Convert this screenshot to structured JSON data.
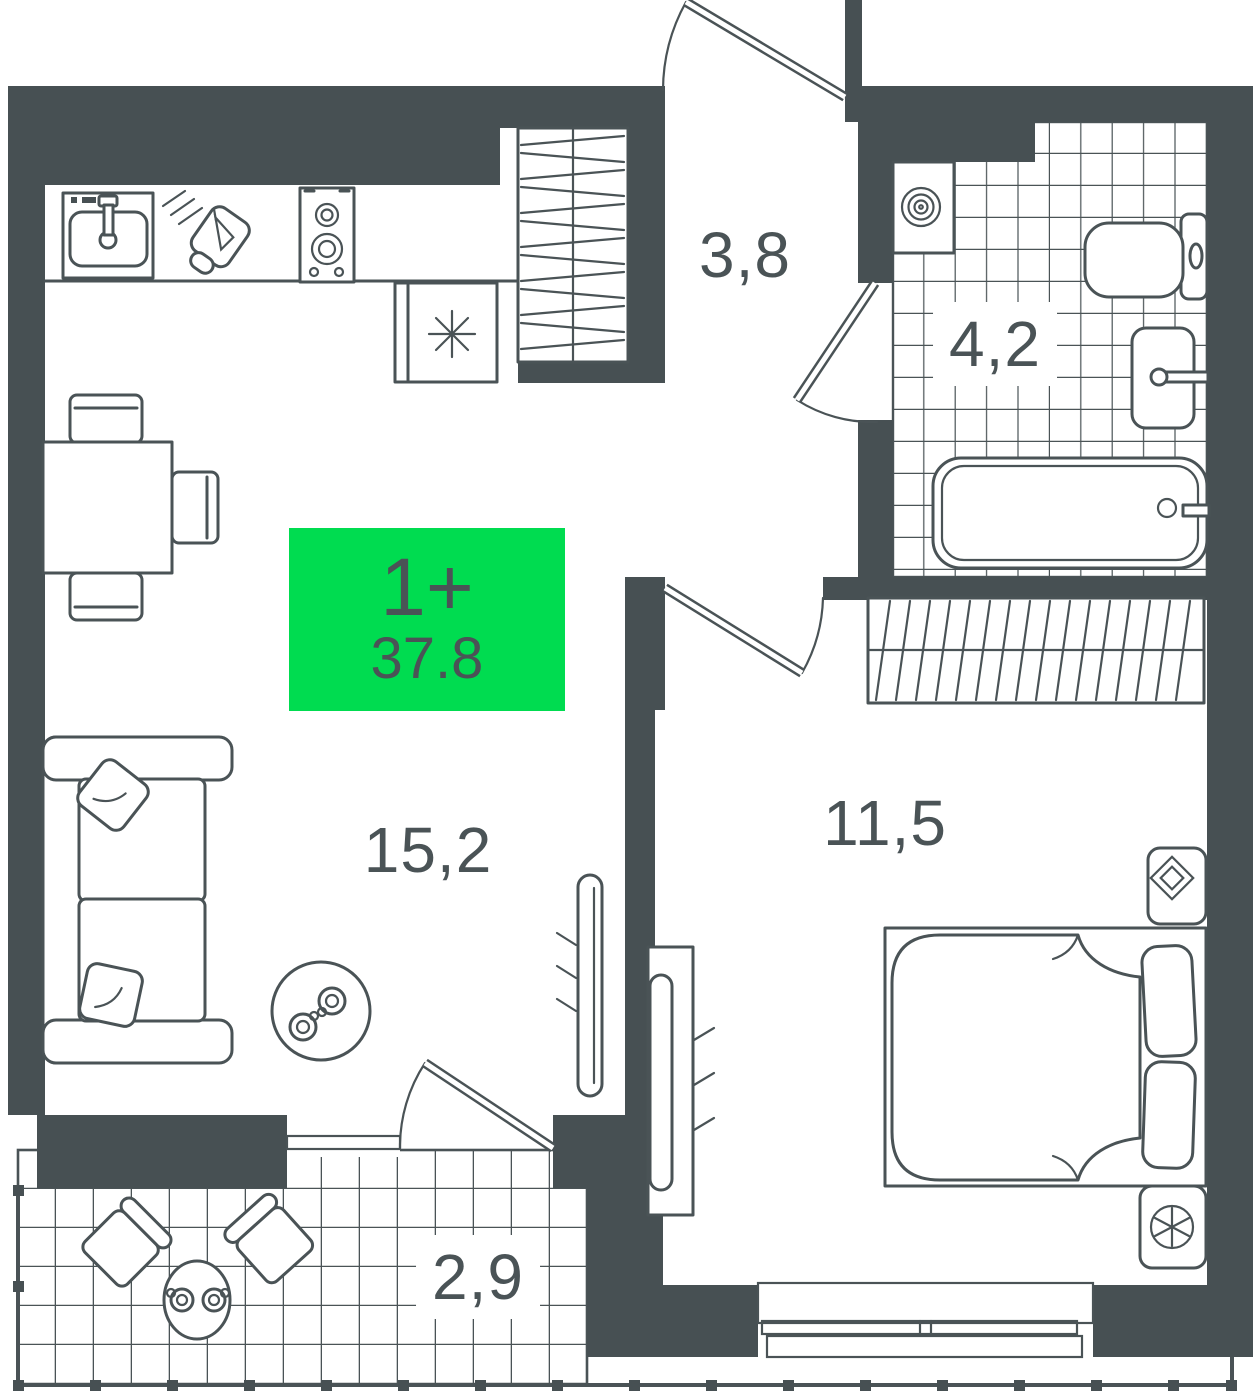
{
  "plan": {
    "badge": {
      "type": "1+",
      "area": "37.8"
    },
    "rooms": {
      "hallway": {
        "area": "3,8"
      },
      "bathroom": {
        "area": "4,2"
      },
      "living": {
        "area": "15,2"
      },
      "bedroom": {
        "area": "11,5"
      },
      "balcony": {
        "area": "2,9"
      }
    },
    "colors": {
      "wall": "#475053",
      "line": "#4a5356",
      "badge_green": "#00dc50",
      "badge_text": "#4a5356",
      "background": "#ffffff"
    },
    "fixture_icons": [
      "kitchen-sink-icon",
      "cutting-board-icon",
      "stove-icon",
      "fridge-snowflake-icon",
      "hall-closet-icon",
      "washing-machine-icon",
      "toilet-icon",
      "bathroom-sink-icon",
      "bathtub-icon",
      "dining-table-icon",
      "chair-icon",
      "sofa-icon",
      "coffee-table-icon",
      "radiator-icon",
      "bed-icon",
      "wardrobe-icon",
      "nightstand-icon",
      "fan-icon",
      "balcony-chair-icon",
      "balcony-table-icon",
      "railing-icon",
      "door-swing-icon",
      "window-icon"
    ]
  }
}
